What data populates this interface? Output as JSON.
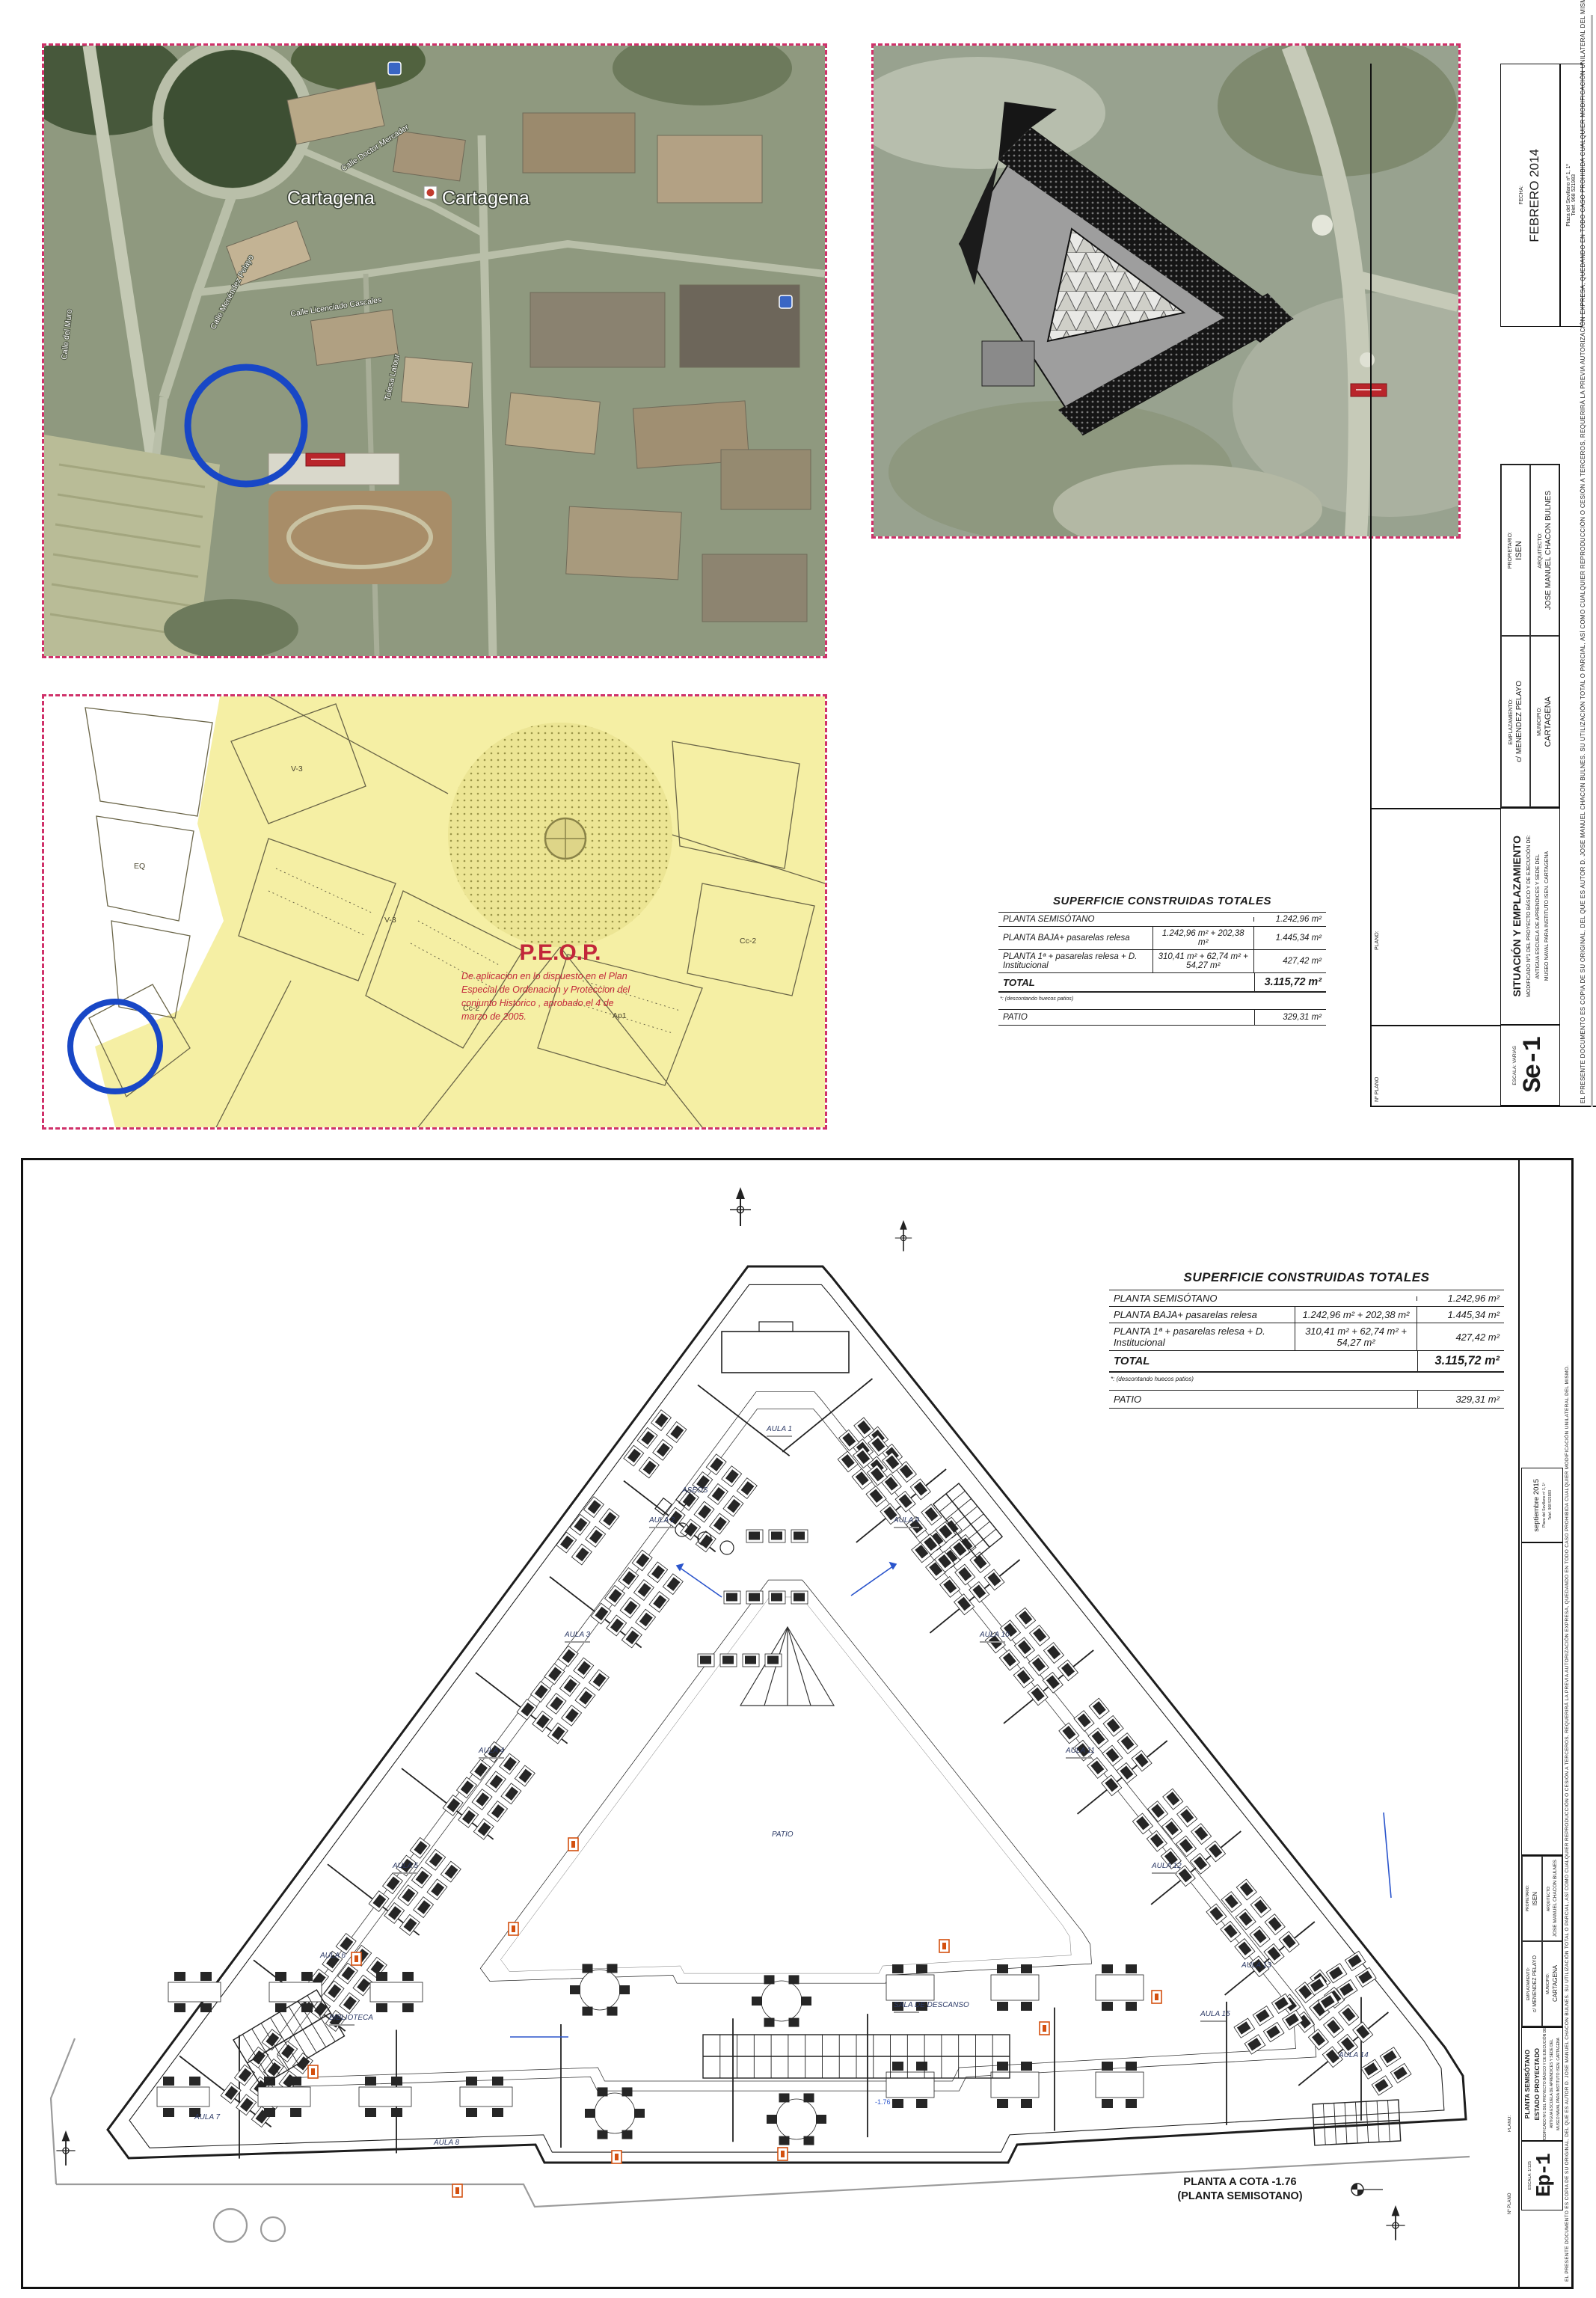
{
  "surface_table": {
    "title": "SUPERFICIE CONSTRUIDAS TOTALES",
    "rows": [
      {
        "label": "PLANTA SEMISÓTANO",
        "detail": "",
        "total": "1.242,96 m²"
      },
      {
        "label": "PLANTA BAJA+ pasarelas relesa",
        "detail": "1.242,96 m² + 202,38 m²",
        "total": "1.445,34 m²"
      },
      {
        "label": "PLANTA 1ª + pasarelas relesa + D. Institucional",
        "detail": "310,41 m² + 62,74 m² + 54,27 m²",
        "total": "427,42 m²"
      }
    ],
    "total_label": "TOTAL",
    "total_value": "3.115,72 m²",
    "note": "*: (descontando huecos patios)",
    "patio_label": "PATIO",
    "patio_value": "329,31 m²"
  },
  "title_block": {
    "labels": {
      "fecha": "FECHA:",
      "emplazamiento": "EMPLAZAMIENTO:",
      "propietario": "PROPIETARIO:",
      "municipio": "MUNICIPIO:",
      "arquitecto": "ARQUITECTO:",
      "plano": "PLANO:",
      "num_plano": "Nº PLANO",
      "escala": "ESCALA:"
    },
    "emplazamiento": "c/ MENENDEZ PELAYO",
    "propietario": "ISEN",
    "municipio": "CARTAGENA",
    "arquitecto": "JOSE MANUEL CHACON BULNES",
    "project_intro": "MODIFICADO Nº1 DEL PROYECTO BÁSICO Y DE EJECUCIÓN DE:",
    "project_name_l1": "ANTIGUA ESCUELA DE APRENDICES Y SEDE DEL",
    "project_name_l2": "MUSEO NAVAL PARA INSTITUTO ISEN. CARTAGENA",
    "address_line1": "Plaza del Sevillano nº 1, 1º",
    "address_line2": "Telef. 968 521983",
    "disclaimer": "EL PRESENTE DOCUMENTO ES COPIA DE SU ORIGINAL, DEL QUE ES AUTOR D. JOSE MANUEL CHACON BULNES. SU UTILIZACIÓN TOTAL O PARCIAL, ASÍ COMO CUALQUIER REPRODUCCIÓN O CESIÓN A TERCEROS, REQUERIRÁ LA PREVIA AUTORIZACIÓN EXPRESA, QUEDANDO EN TODO CASO PROHIBIDA CUALQUIER MODIFICACIÓN UNILATERAL DEL MISMO."
  },
  "sheet_top": {
    "fecha": "FEBRERO 2014",
    "plano_title": "SITUACIÓN Y EMPLAZAMIENTO",
    "sheet_no": "Se-1",
    "escala": "ESCALA:  VARIAS",
    "aerial1": {
      "city_label_1": "Cartagena",
      "city_label_2": "Cartagena",
      "streets": [
        "Calle Doctor Mercader",
        "Calle Menéndez Pelayo",
        "Calle Licenciado Cascales",
        "Calle del Muro",
        "Tolosa Latour"
      ]
    },
    "peop": {
      "title": "P.E.O.P.",
      "body_l1": "De aplicacion en lo dispuesto en el Plan",
      "body_l2": "Especial de Ordenacion y Proteccion del",
      "body_l3": "conjunto Historico , aprobado el 4 de",
      "body_l4": "marzo de 2005.",
      "parcels": [
        "V-3",
        "Cc-2",
        "Ap1",
        "EQ",
        "V-3",
        "Cc-2"
      ]
    }
  },
  "sheet_bottom": {
    "fecha": "septiembre 2015",
    "plano_title_l1": "PLANTA SEMISÓTANO",
    "plano_title_l2": "ESTADO PROYECTADO",
    "sheet_no": "Ep-1",
    "escala": "ESCALA:  1/125",
    "caption_line1": "PLANTA A COTA -1.76",
    "caption_line2": "(PLANTA SEMISOTANO)",
    "level_mark": "-1.76",
    "rooms": {
      "aula1": "AULA 1",
      "aula2": "AULA 2",
      "aula3": "AULA 3",
      "aula4": "AULA 4",
      "aula5": "AULA 5",
      "aula6": "AULA 6",
      "aula7": "AULA 7",
      "aula8": "AULA 8",
      "aula9": "AULA 9",
      "aula10": "AULA 10",
      "aula11": "AULA 11",
      "aula12": "AULA 12",
      "aula13": "AULA 13",
      "aula14": "AULA 14",
      "aula15": "AULA 15",
      "biblioteca": "BIBLIOTECA",
      "descanso": "SALA DE DESCANSO",
      "aseos": "ASEOS",
      "patio": "PATIO"
    }
  }
}
